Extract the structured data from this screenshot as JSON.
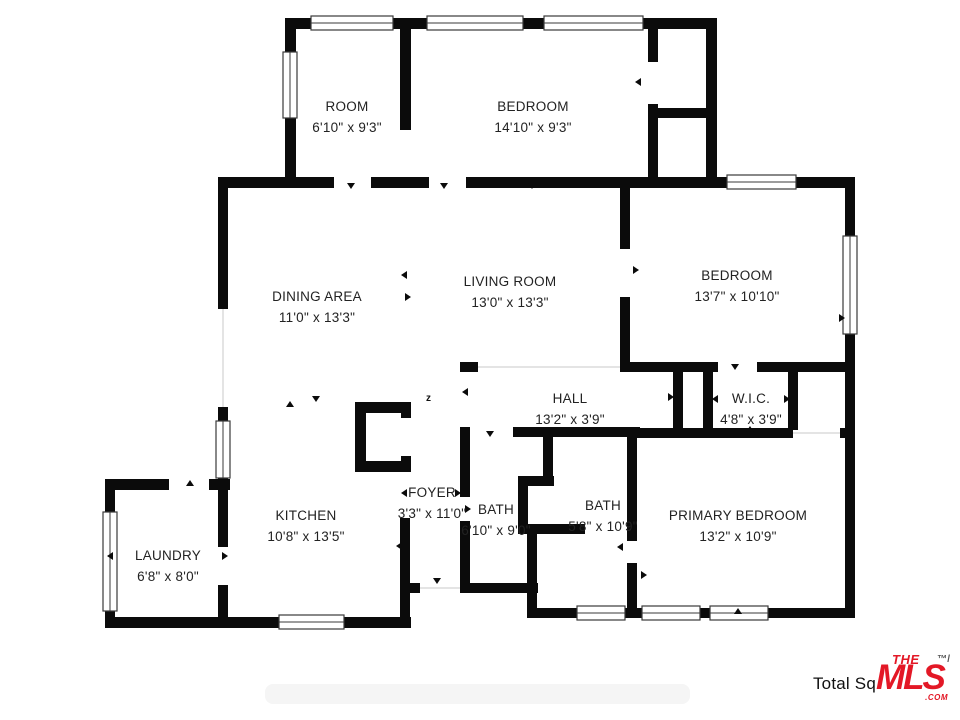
{
  "meta": {
    "type": "residential floor plan"
  },
  "rooms": [
    {
      "name": "ROOM",
      "dims": "6'10\" x 9'3\""
    },
    {
      "name": "BEDROOM",
      "dims": "14'10\" x 9'3\""
    },
    {
      "name": "DINING AREA",
      "dims": "11'0\" x 13'3\""
    },
    {
      "name": "LIVING ROOM",
      "dims": "13'0\" x 13'3\""
    },
    {
      "name": "BEDROOM",
      "dims": "13'7\" x 10'10\""
    },
    {
      "name": "HALL",
      "dims": "13'2\" x 3'9\""
    },
    {
      "name": "W.I.C.",
      "dims": "4'8\" x 3'9\""
    },
    {
      "name": "FOYER",
      "dims": "3'3\" x 11'0\""
    },
    {
      "name": "KITCHEN",
      "dims": "10'8\" x 13'5\""
    },
    {
      "name": "BATH",
      "dims": "6'10\" x 9'0\""
    },
    {
      "name": "BATH",
      "dims": "5'8\" x 10'9\""
    },
    {
      "name": "LAUNDRY",
      "dims": "6'8\" x 8'0\""
    },
    {
      "name": "PRIMARY BEDROOM",
      "dims": "13'2\" x 10'9\""
    }
  ],
  "markers": {
    "north_marker": "z"
  },
  "footer": {
    "total_label": "Total Sq",
    "logo": {
      "the": "THE",
      "mls": "MLS",
      "tm": "™/",
      "com": ".COM",
      "color": "#e31826"
    }
  },
  "colors": {
    "walls": "#0b0b0b",
    "logo_red": "#e31826"
  }
}
